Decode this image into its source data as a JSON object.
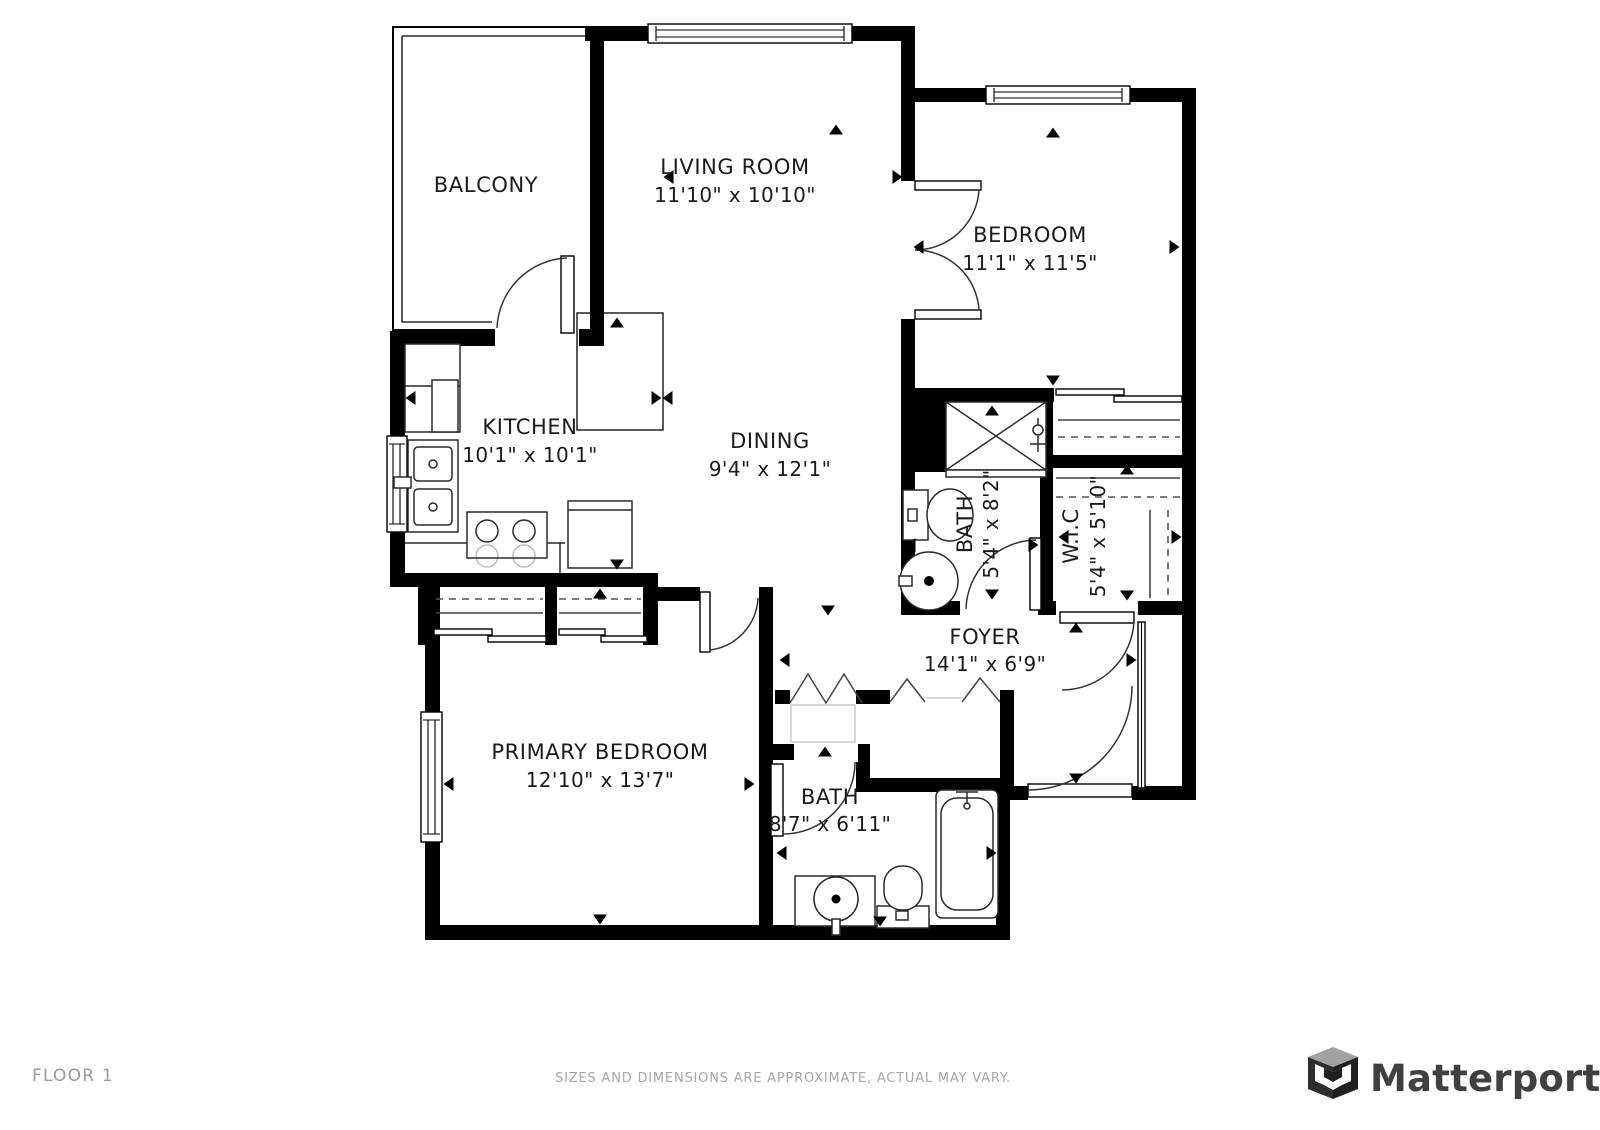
{
  "plan": {
    "rooms": [
      {
        "name": "BALCONY",
        "dims": ""
      },
      {
        "name": "LIVING ROOM",
        "dims": "11'10\" x 10'10\""
      },
      {
        "name": "BEDROOM",
        "dims": "11'1\" x 11'5\""
      },
      {
        "name": "KITCHEN",
        "dims": "10'1\" x 10'1\""
      },
      {
        "name": "DINING",
        "dims": "9'4\" x 12'1\""
      },
      {
        "name": "BATH",
        "dims": "5'4\" x 8'2\""
      },
      {
        "name": "W.I.C",
        "dims": "5'4\" x 5'10\""
      },
      {
        "name": "FOYER",
        "dims": "14'1\" x 6'9\""
      },
      {
        "name": "PRIMARY BEDROOM",
        "dims": "12'10\" x 13'7\""
      },
      {
        "name": "BATH",
        "dims": "8'7\" x 6'11\""
      }
    ]
  },
  "footer": {
    "floor_label": "FLOOR 1",
    "disclaimer": "SIZES AND DIMENSIONS ARE APPROXIMATE, ACTUAL MAY VARY.",
    "brand": "Matterport"
  }
}
